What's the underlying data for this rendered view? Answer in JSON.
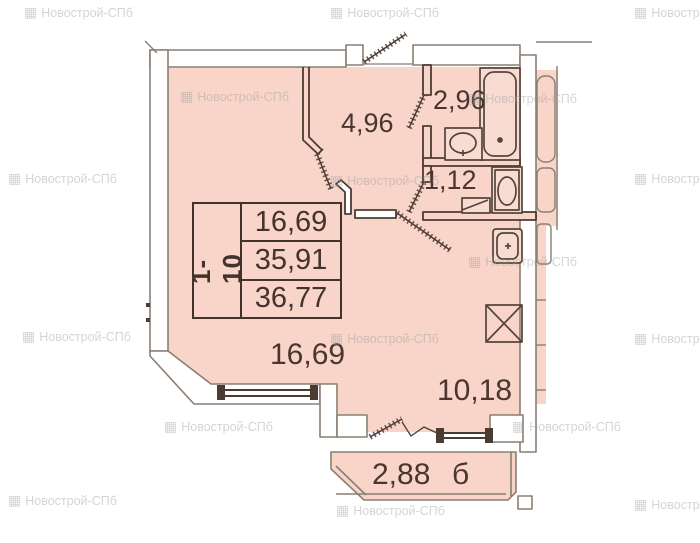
{
  "watermark": {
    "text": "Новострой-СПб",
    "icon": "building-icon"
  },
  "rooms": {
    "hallway": {
      "area": "4,96"
    },
    "bathroom": {
      "area": "2,96"
    },
    "wc": {
      "area": "1,12"
    },
    "living_room": {
      "area": "16,69"
    },
    "kitchen": {
      "area": "10,18"
    },
    "balcony": {
      "area": "2,88",
      "letter": "б"
    }
  },
  "info_table": {
    "apartments": "1-10",
    "rows": [
      "16,69",
      "35,91",
      "36,77"
    ]
  },
  "colors": {
    "floor_fill": "#f8d5c8",
    "line_dark": "#4c3b33",
    "wall_outline": "#8a7e73",
    "label_text": "#4a362e",
    "watermark_gray": "#9b9b9b"
  }
}
